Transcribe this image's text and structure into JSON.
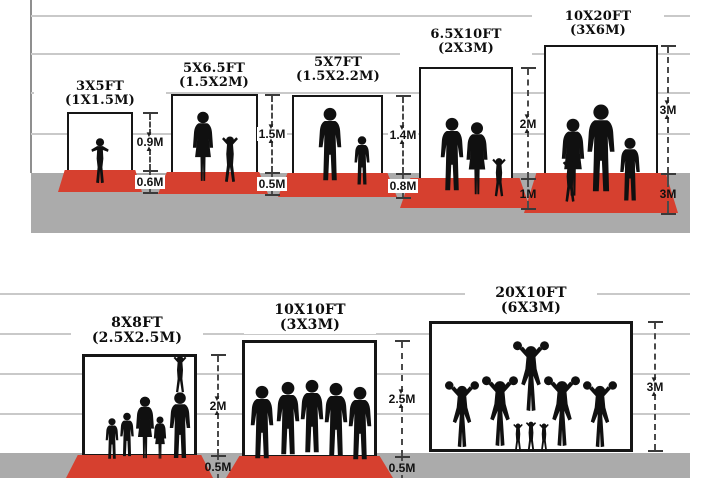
{
  "scenes": [
    {
      "panels": [
        {
          "ft": "3X5FT",
          "m": "(1X1.5M)",
          "wall": "0.9M",
          "floor": "0.6M",
          "figures": "toddler-silhouette"
        },
        {
          "ft": "5X6.5FT",
          "m": "(1.5X2M)",
          "wall": "1.5M",
          "floor": "0.5M",
          "figures": "mother-and-child-silhouettes"
        },
        {
          "ft": "5X7FT",
          "m": "(1.5X2.2M)",
          "wall": "1.4M",
          "floor": "0.8M",
          "figures": "father-and-son-silhouettes"
        },
        {
          "ft": "6.5X10FT",
          "m": "(2X3M)",
          "wall": "2M",
          "floor": "1M",
          "figures": "family-of-three-silhouettes"
        },
        {
          "ft": "10X20FT",
          "m": "(3X6M)",
          "wall": "3M",
          "floor": "3M",
          "figures": "family-of-four-silhouettes"
        }
      ]
    },
    {
      "panels": [
        {
          "ft": "8X8FT",
          "m": "(2.5X2.5M)",
          "wall": "2M",
          "floor": "0.5M",
          "figures": "family-group-silhouettes"
        },
        {
          "ft": "10X10FT",
          "m": "(3X3M)",
          "wall": "2.5M",
          "floor": "0.5M",
          "figures": "sports-team-silhouettes"
        },
        {
          "ft": "20X10FT",
          "m": "(6X3M)",
          "wall": "3M",
          "figures": "cheerleader-squad-silhouettes"
        }
      ]
    }
  ],
  "colors": {
    "carpet_red": "#d6402f",
    "ground_gray": "#ababab",
    "wall_line_gray": "#c9c9c9",
    "frame_black": "#161616"
  }
}
